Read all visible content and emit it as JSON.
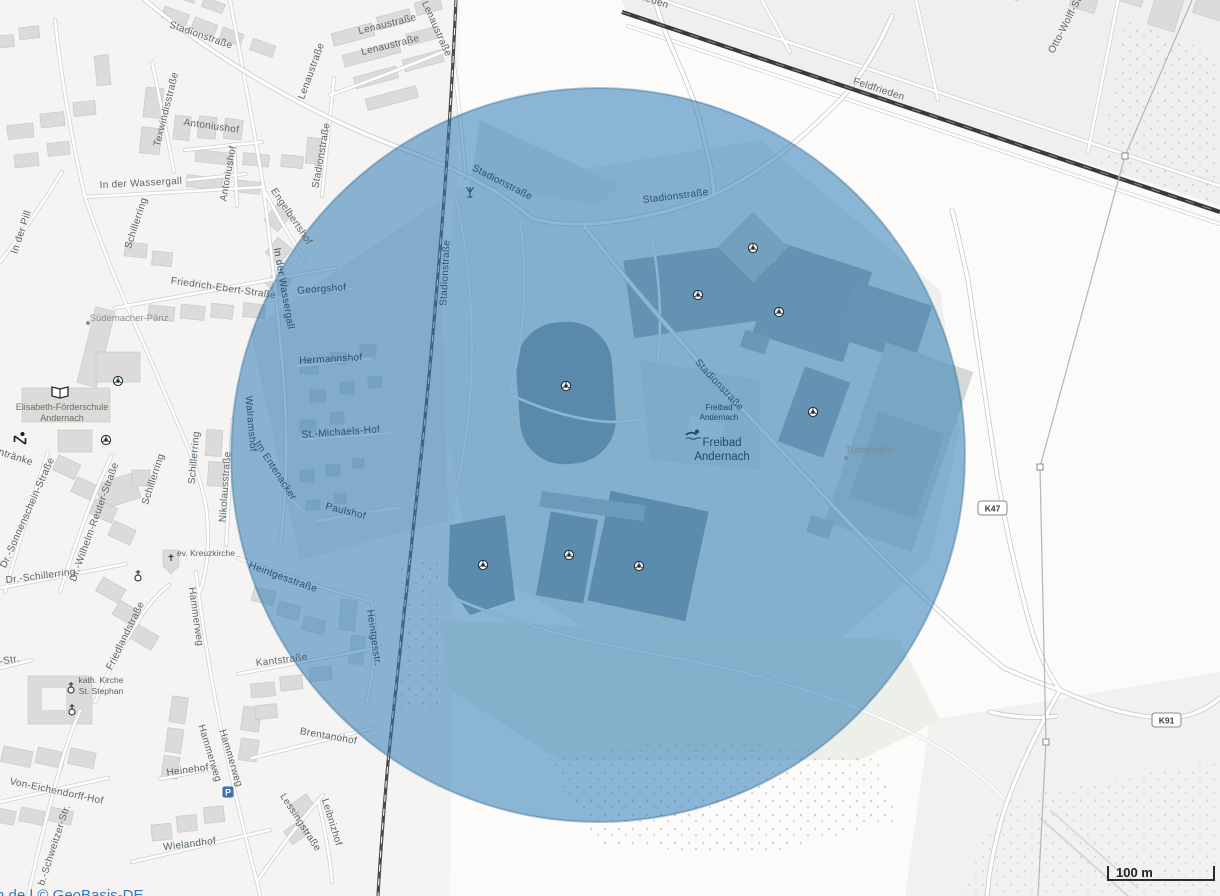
{
  "map": {
    "attribution": "n.de | © GeoBasis-DE",
    "scale_label": "100 m",
    "parking_label": "P",
    "badges": [
      {
        "text": "K47"
      },
      {
        "text": "K91"
      }
    ],
    "overlay": {
      "color": "#2e7cb4",
      "opacity": 0.55,
      "shape": "circle"
    },
    "streets": [
      {
        "text": "Lenaustraße"
      },
      {
        "text": "Lenaustraße"
      },
      {
        "text": "Lenaustraße"
      },
      {
        "text": "Lenaustraße"
      },
      {
        "text": "Stadionstraße"
      },
      {
        "text": "Texwindisstraße"
      },
      {
        "text": "Antoniushof"
      },
      {
        "text": "Antoniushof"
      },
      {
        "text": "Stadionstraße"
      },
      {
        "text": "In der Wassergall"
      },
      {
        "text": "Schillerring"
      },
      {
        "text": "In der Pill"
      },
      {
        "text": "Engelbertshof"
      },
      {
        "text": "In der Wassergall"
      },
      {
        "text": "Friedrich-Ebert-Straße"
      },
      {
        "text": "Georgshof"
      },
      {
        "text": "Hermannshof"
      },
      {
        "text": "St.-Michaels-Hof"
      },
      {
        "text": "Walramshof"
      },
      {
        "text": "Im Entenacker"
      },
      {
        "text": "Paulshof"
      },
      {
        "text": "Nikolausstraße"
      },
      {
        "text": "entränke"
      },
      {
        "text": "Dr.-Sonnenschein-Straße"
      },
      {
        "text": "Dr.-Schillerring"
      },
      {
        "text": "Dr.-Wilhelm-Reuter-Straße"
      },
      {
        "text": "Schillerring"
      },
      {
        "text": "Schillerring"
      },
      {
        "text": "Heintgesstraße"
      },
      {
        "text": "Hammerweg"
      },
      {
        "text": "Friedlandstraße"
      },
      {
        "text": "Kantstraße"
      },
      {
        "text": "Heintgesstr."
      },
      {
        "text": "-Str."
      },
      {
        "text": "Brentanohof"
      },
      {
        "text": "Von-Eichendorff-Hof"
      },
      {
        "text": "b.-Schweitzer-Str."
      },
      {
        "text": "Heinehof"
      },
      {
        "text": "Hammerweg"
      },
      {
        "text": "Hammerweg"
      },
      {
        "text": "Wielandhof"
      },
      {
        "text": "Lessingstraße"
      },
      {
        "text": "Leibnizhof"
      },
      {
        "text": "Stadionstraße"
      },
      {
        "text": "Stadionstraße"
      },
      {
        "text": "Stadionstraße"
      },
      {
        "text": "Stadionstraße"
      },
      {
        "text": "Feldfrieden"
      },
      {
        "text": "Feldfrieden"
      },
      {
        "text": "Otto-Wolff-Str."
      }
    ],
    "pois": {
      "suedemacher": "Südemacher-Pänz",
      "school_line1": "Elisabeth-Förderschule",
      "school_line2": "Andernach",
      "kreuzkirche": "ev. Kreuzkirche",
      "kath_line1": "kath. Kirche",
      "kath_line2": "St. Stephan",
      "freibad_small_line1": "Freibad",
      "freibad_small_line2": "Andernach",
      "freibad_line1": "Freibad",
      "freibad_line2": "Andernach",
      "trampolino": "Trampolino"
    },
    "icons": {
      "soccer": "soccer-ball-icon",
      "mast": "antenna-mast-icon",
      "book": "school-book-icon",
      "swimmer": "swimmer-icon",
      "parking": "parking-icon",
      "church_pentagon": "church-cross-icon",
      "church_circle": "church-cross-icon",
      "playground": "playground-slide-icon"
    }
  }
}
